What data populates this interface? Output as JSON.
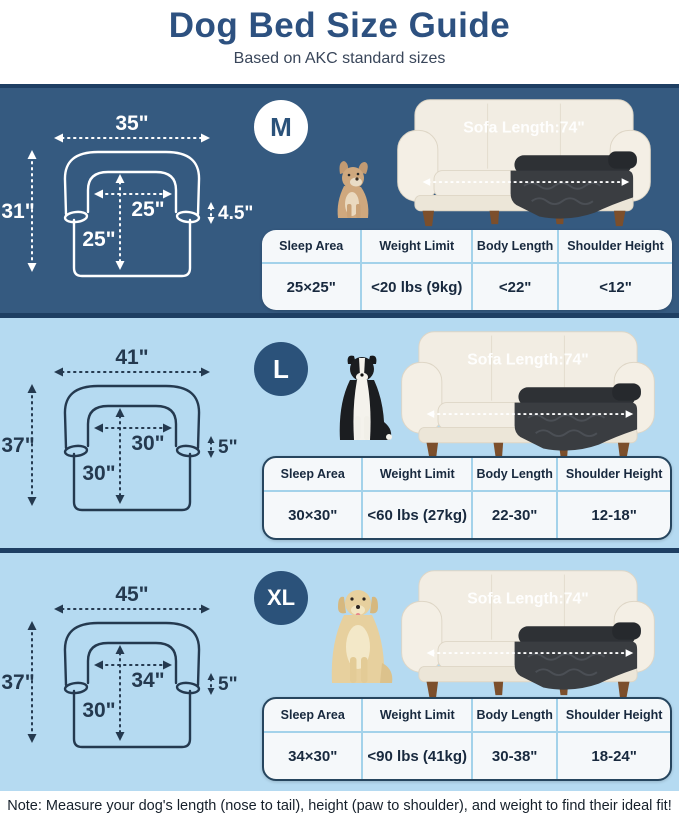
{
  "header": {
    "title": "Dog Bed Size Guide",
    "subtitle": "Based on AKC standard sizes"
  },
  "sections": [
    {
      "size_label": "M",
      "dog": "french-bulldog",
      "sofa_label": "Sofa Length:74\"",
      "diagram": {
        "top_width": "35\"",
        "left_height": "31\"",
        "inner_width": "25\"",
        "inner_height": "25\"",
        "side_drop": "4.5\""
      },
      "table": {
        "headers": [
          "Sleep Area",
          "Weight Limit",
          "Body Length",
          "Shoulder Height"
        ],
        "values": [
          "25×25\"",
          "<20 lbs (9kg)",
          "<22\"",
          "<12\""
        ]
      }
    },
    {
      "size_label": "L",
      "dog": "border-collie",
      "sofa_label": "Sofa Length:74\"",
      "diagram": {
        "top_width": "41\"",
        "left_height": "37\"",
        "inner_width": "30\"",
        "inner_height": "30\"",
        "side_drop": "5\""
      },
      "table": {
        "headers": [
          "Sleep Area",
          "Weight Limit",
          "Body Length",
          "Shoulder Height"
        ],
        "values": [
          "30×30\"",
          "<60 lbs (27kg)",
          "22-30\"",
          "12-18\""
        ]
      }
    },
    {
      "size_label": "XL",
      "dog": "golden-retriever",
      "sofa_label": "Sofa Length:74\"",
      "diagram": {
        "top_width": "45\"",
        "left_height": "37\"",
        "inner_width": "34\"",
        "inner_height": "30\"",
        "side_drop": "5\""
      },
      "table": {
        "headers": [
          "Sleep Area",
          "Weight Limit",
          "Body Length",
          "Shoulder Height"
        ],
        "values": [
          "34×30\"",
          "<90 lbs (41kg)",
          "30-38\"",
          "18-24\""
        ]
      }
    }
  ],
  "footer": {
    "note": "Note: Measure your dog's length (nose to tail), height (paw to shoulder), and weight to find their ideal fit!"
  },
  "colors": {
    "navy_section": "#355a80",
    "light_section": "#b5daf1",
    "separator": "#1e3f63",
    "title_text": "#2d5180",
    "circle_navy": "#2b527a",
    "table_divider": "#a3d2ea",
    "bed_dark": "#3a3d41"
  }
}
